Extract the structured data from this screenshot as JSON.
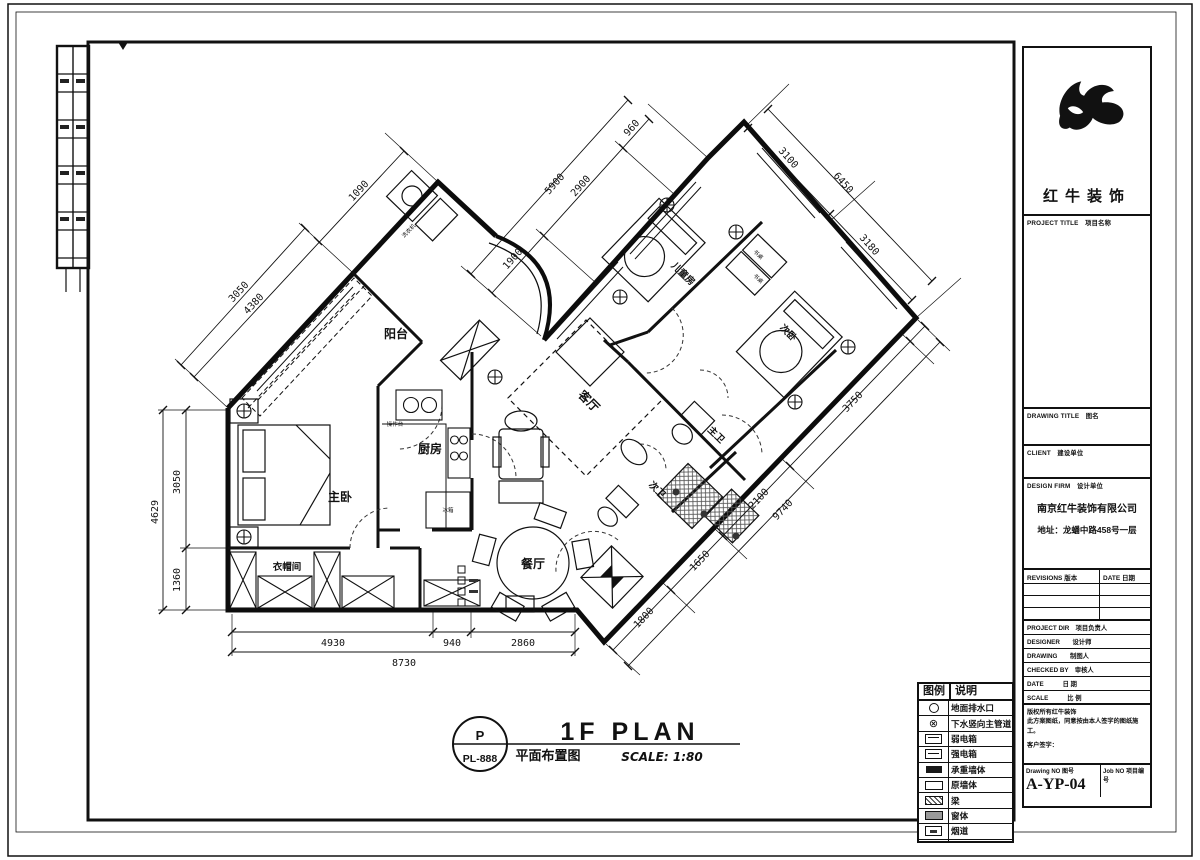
{
  "title_block": {
    "brand": "红牛装饰",
    "labels": {
      "project_title": "PROJECT TITLE　项目名称",
      "drawing_title": "DRAWING TITLE　图名",
      "client": "CLIENT　建设单位",
      "design_firm": "DESIGN FIRM　设计单位",
      "revisions": "REVISIONS 版本",
      "date_col": "DATE 日期",
      "project_dir": "PROJECT DIR　项目负责人",
      "designer": "DESIGNER　　设计师",
      "drawing": "DRAWING　　制图人",
      "checked_by": "CHECKED BY　审核人",
      "date": "DATE　　　日 期",
      "scale": "SCALE　　　比 例",
      "drawing_no": "Drawing NO 图号",
      "job_no": "Job NO 项目编号"
    },
    "firm_name": "南京红牛装饰有限公司",
    "firm_address": "地址：龙蟠中路458号一层",
    "note_line1": "版权所有红牛装饰",
    "note_line2": "此方案图纸，同意按由本人签字的图纸施工。",
    "note_line3": "客户签字：",
    "drawing_number": "A-YP-04"
  },
  "plan_title": {
    "mark": "P",
    "mark_no": "PL-888",
    "title_en": "1F PLAN",
    "title_cn": "平面布置图",
    "scale": "SCALE: 1:80"
  },
  "legend": {
    "header": {
      "symbol": "图例",
      "desc": "说明"
    },
    "rows": [
      {
        "label": "地面排水口"
      },
      {
        "label": "下水竖向主管道"
      },
      {
        "label": "弱电箱"
      },
      {
        "label": "强电箱"
      },
      {
        "label": "承重墙体"
      },
      {
        "label": "原墙体"
      },
      {
        "label": "梁"
      },
      {
        "label": "窗体"
      },
      {
        "label": "烟道"
      },
      {
        "label": "燃气管道"
      }
    ],
    "pipe_glyph": "⊗"
  },
  "rooms": {
    "balcony": "阳台",
    "kitchen": "厨房",
    "master": "主卧",
    "cloak": "衣帽间",
    "dining": "餐厅",
    "living": "客厅",
    "kids": "儿童房",
    "second": "次卧",
    "mbath": "主卫",
    "sbath": "次卫"
  },
  "furniture": {
    "washer": "洗衣机",
    "counter": "操作台",
    "fridge": "冰箱",
    "desk": "书桌"
  },
  "dims": {
    "left_total": "4629",
    "left_a": "3050",
    "left_b": "1360",
    "nw_total": "4380",
    "nw_a": "3050",
    "nw_b": "1090",
    "top_total": "5900",
    "top_a": "1900",
    "top_b": "2900",
    "top_c": "960",
    "ne_total": "6450",
    "ne_a": "3100",
    "ne_b": "3180",
    "se_total": "9740",
    "se_a": "1800",
    "se_b": "1650",
    "se_c": "2100",
    "se_d": "3750",
    "bottom_total": "8730",
    "bottom_a": "4930",
    "bottom_b": "940",
    "bottom_c": "2860"
  }
}
